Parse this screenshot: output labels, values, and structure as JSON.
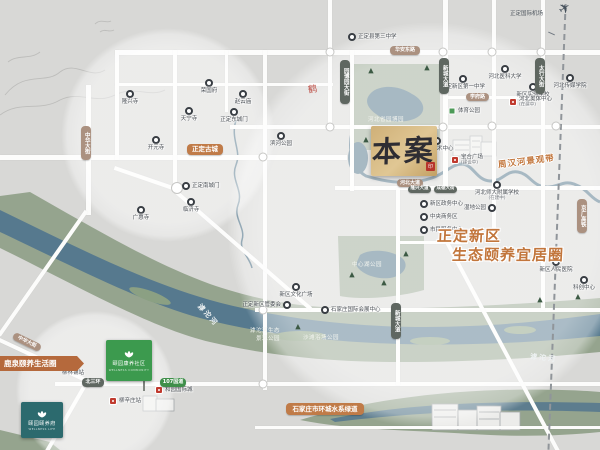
{
  "project": {
    "marker": "本案",
    "seal": "印"
  },
  "slogan": {
    "line1": "正定新区",
    "line2": "生态颐养宜居圈"
  },
  "ribbon": {
    "label": "鹿泉颐养生活圈"
  },
  "brand": {
    "green_sign": {
      "name": "颐园康养社区",
      "sub": "WELLNESS COMMUNITY"
    },
    "teal_card": {
      "name": "颐园颐养府",
      "sub": "WELLNESS LIFE"
    }
  },
  "icons": {
    "plane": "✈",
    "tree": "▲",
    "ornament": "鹤"
  },
  "area_labels": [
    {
      "t": "河北省园博园",
      "x": 368,
      "y": 118,
      "cls": "park-label",
      "rot": 0
    },
    {
      "t": "中心湖公园",
      "x": 352,
      "y": 263,
      "cls": "park-label",
      "rot": 0
    },
    {
      "t": "滹沱河生态",
      "x": 250,
      "y": 329,
      "cls": "park-label",
      "rot": 0
    },
    {
      "t": "景观公园",
      "x": 256,
      "y": 337,
      "cls": "park-label",
      "rot": 0
    },
    {
      "t": "沙滩浴场公园",
      "x": 303,
      "y": 336,
      "cls": "park-label",
      "rot": 0
    },
    {
      "t": "滹沱河",
      "x": 194,
      "y": 312,
      "cls": "river-label",
      "rot": 48
    },
    {
      "t": "滹沱河",
      "x": 530,
      "y": 355,
      "cls": "river-label",
      "rot": 6
    },
    {
      "t": "周汉河景观带",
      "x": 498,
      "y": 158,
      "cls": "orange-river-label",
      "rot": -7
    },
    {
      "t": "正定国际机场",
      "x": 510,
      "y": 12,
      "cls": "airport-label",
      "rot": 0
    }
  ],
  "road_badges": [
    {
      "t": "华安东路",
      "x": 390,
      "y": 46,
      "w": 30,
      "h": 9,
      "type": "tan",
      "fs": 5
    },
    {
      "t": "学府路",
      "x": 466,
      "y": 93,
      "w": 23,
      "h": 8,
      "type": "tan",
      "fs": 5
    },
    {
      "t": "河北大道",
      "x": 397,
      "y": 179,
      "w": 26,
      "h": 8,
      "type": "tan",
      "fs": 5
    },
    {
      "t": "正定古城",
      "x": 187,
      "y": 144,
      "w": 36,
      "h": 11,
      "type": "orange",
      "fs": 6.5
    },
    {
      "t": "石家庄市环城水系绿道",
      "x": 286,
      "y": 403,
      "w": 78,
      "h": 12,
      "type": "orange",
      "fs": 6.5
    },
    {
      "t": "中华大街",
      "x": 81,
      "y": 126,
      "w": 10,
      "h": 34,
      "type": "tan",
      "fs": 5.5,
      "vert": true
    },
    {
      "t": "中华大街",
      "x": 12,
      "y": 338,
      "w": 30,
      "h": 8,
      "type": "tan",
      "fs": 5,
      "rot": 26
    },
    {
      "t": "园博园大街",
      "x": 340,
      "y": 60,
      "w": 10,
      "h": 44,
      "type": "dark",
      "fs": 5.5,
      "vert": true
    },
    {
      "t": "新城大道",
      "x": 439,
      "y": 58,
      "w": 10,
      "h": 36,
      "type": "dark",
      "fs": 5.5,
      "vert": true
    },
    {
      "t": "太行大街",
      "x": 535,
      "y": 58,
      "w": 10,
      "h": 36,
      "type": "dark",
      "fs": 5.5,
      "vert": true
    },
    {
      "t": "新城大道",
      "x": 391,
      "y": 303,
      "w": 10,
      "h": 36,
      "type": "dark",
      "fs": 5.5,
      "vert": true
    },
    {
      "t": "京广高铁",
      "x": 577,
      "y": 199,
      "w": 10,
      "h": 34,
      "type": "tan",
      "fs": 5.5,
      "vert": true
    },
    {
      "t": "隆兴大道",
      "x": 408,
      "y": 186,
      "w": 23,
      "h": 7,
      "type": "dark",
      "fs": 4.5
    },
    {
      "t": "成德大街",
      "x": 434,
      "y": 186,
      "w": 23,
      "h": 7,
      "type": "dark",
      "fs": 4.5
    },
    {
      "t": "北三环",
      "x": 82,
      "y": 378,
      "w": 22,
      "h": 9,
      "type": "dark",
      "fs": 5
    },
    {
      "t": "107国道",
      "x": 160,
      "y": 378,
      "w": 26,
      "h": 9,
      "type": "green",
      "fs": 5
    }
  ],
  "pois": [
    {
      "x": 130,
      "y": 94,
      "label": "隆兴寺",
      "type": "ring",
      "lp": "b"
    },
    {
      "x": 209,
      "y": 83,
      "label": "荣国府",
      "type": "ring",
      "lp": "b"
    },
    {
      "x": 243,
      "y": 94,
      "label": "赵云庙",
      "type": "ring",
      "lp": "b"
    },
    {
      "x": 189,
      "y": 111,
      "label": "天宁寺",
      "type": "ring",
      "lp": "b"
    },
    {
      "x": 234,
      "y": 112,
      "label": "正定东城门",
      "type": "ring",
      "lp": "b"
    },
    {
      "x": 281,
      "y": 136,
      "label": "滨河公园",
      "type": "ring",
      "lp": "b"
    },
    {
      "x": 156,
      "y": 140,
      "label": "开元寺",
      "type": "ring",
      "lp": "b"
    },
    {
      "x": 186,
      "y": 186,
      "label": "正定南城门",
      "type": "ring",
      "lp": "r"
    },
    {
      "x": 191,
      "y": 202,
      "label": "临济寺",
      "type": "ring",
      "lp": "b"
    },
    {
      "x": 141,
      "y": 210,
      "label": "广惠寺",
      "type": "ring",
      "lp": "b"
    },
    {
      "x": 352,
      "y": 37,
      "label": "正定县第三中学",
      "type": "ring",
      "lp": "r"
    },
    {
      "x": 463,
      "y": 79,
      "label": "正定新区第一中学",
      "type": "ring",
      "lp": "b"
    },
    {
      "x": 505,
      "y": 69,
      "label": "河北医科大学",
      "type": "ring",
      "lp": "b"
    },
    {
      "x": 533,
      "y": 87,
      "label": "新区实验学校",
      "type": "ring",
      "lp": "b"
    },
    {
      "x": 570,
      "y": 78,
      "label": "河北传媒学院",
      "type": "ring",
      "lp": "b"
    },
    {
      "x": 513,
      "y": 102,
      "label": "河北奥体中心",
      "sub": "(在建中)",
      "type": "red",
      "lp": "r"
    },
    {
      "x": 452,
      "y": 111,
      "label": "体育公园",
      "type": "green",
      "lp": "r"
    },
    {
      "x": 437,
      "y": 141,
      "label": "文化艺术中心",
      "type": "ring",
      "lp": "b"
    },
    {
      "x": 455,
      "y": 160,
      "label": "宝合广场",
      "sub": "(建设中)",
      "type": "red",
      "lp": "r"
    },
    {
      "x": 424,
      "y": 204,
      "label": "新区政务中心",
      "type": "ring",
      "lp": "r"
    },
    {
      "x": 424,
      "y": 217,
      "label": "中央商务区",
      "type": "ring",
      "lp": "r"
    },
    {
      "x": 424,
      "y": 230,
      "label": "市民服务中心",
      "type": "ring",
      "lp": "r"
    },
    {
      "x": 497,
      "y": 185,
      "label": "河北师大附属学校",
      "sub": "(在建中)",
      "type": "ring",
      "lp": "b"
    },
    {
      "x": 492,
      "y": 208,
      "label": "湿地公园",
      "type": "ring",
      "lp": "l"
    },
    {
      "x": 556,
      "y": 262,
      "label": "新区人民医院",
      "type": "ring",
      "lp": "b"
    },
    {
      "x": 584,
      "y": 280,
      "label": "科创中心",
      "type": "ring",
      "lp": "b"
    },
    {
      "x": 296,
      "y": 287,
      "label": "新区文化广场",
      "type": "ring",
      "lp": "b"
    },
    {
      "x": 287,
      "y": 305,
      "label": "正定新区管委会",
      "type": "ring",
      "lp": "l"
    },
    {
      "x": 325,
      "y": 310,
      "label": "石家庄国际会展中心",
      "type": "ring",
      "lp": "r"
    },
    {
      "x": 73,
      "y": 365,
      "label": "柳林铺站",
      "type": "red",
      "lp": "b"
    },
    {
      "x": 113,
      "y": 401,
      "label": "柳辛庄站",
      "type": "red",
      "lp": "r"
    },
    {
      "x": 159,
      "y": 390,
      "label": "和园国际城",
      "type": "red",
      "lp": "r"
    }
  ],
  "colors": {
    "background": "#d8d8d6",
    "road": "#fcfcfb",
    "river_water": "#56798e",
    "river_bank": "#95a48e",
    "park": "#9aa994",
    "lake": "#4f7287",
    "accent_orange": "#c2763c",
    "badge_orange": "#c07b48",
    "badge_tan": "#ab9180",
    "badge_dark": "#5f6761",
    "highway_green": "#3f8f4a",
    "site_gold": "#cfb078",
    "seal_red": "#b7352c",
    "brand_green": "#3c9a4e",
    "brand_teal": "#2c6a6e",
    "ribbon_orange": "#b5693c"
  }
}
